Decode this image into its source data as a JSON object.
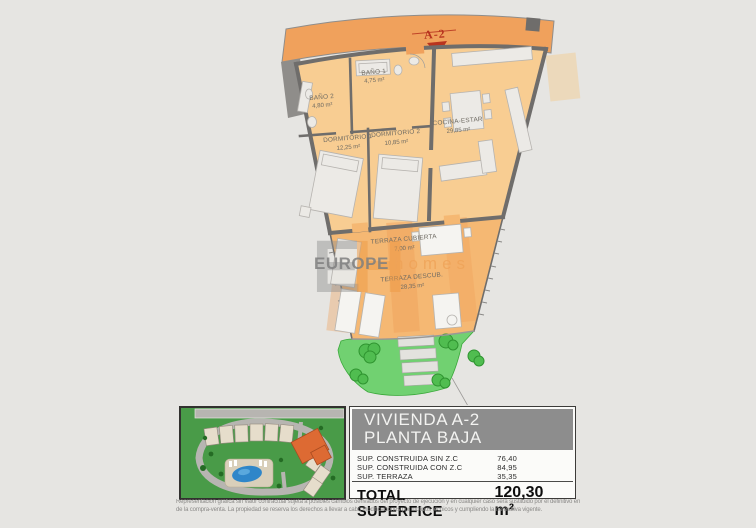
{
  "marker": {
    "label": "A-2"
  },
  "watermark": {
    "monogram_left": "E",
    "monogram_right": "H",
    "brand_primary": "EUROPE",
    "brand_secondary": "homes"
  },
  "rooms": {
    "bano1": {
      "name": "BAÑO 1",
      "area": "4,75 m²"
    },
    "bano2": {
      "name": "BAÑO 2",
      "area": "4,80 m²"
    },
    "dorm1": {
      "name": "DORMITORIO 1",
      "area": "12,25 m²"
    },
    "dorm2": {
      "name": "DORMITORIO 2",
      "area": "10,85 m²"
    },
    "cocina": {
      "name": "COCINA-ESTAR",
      "area": "29,85 m²"
    },
    "terraza_cubierta": {
      "name": "TERRAZA CUBIERTA",
      "area": "7,00 m²"
    },
    "terraza_descubierta": {
      "name": "TERRAZA DESCUB.",
      "area": "28,35 m²"
    }
  },
  "info_panel": {
    "title_line1": "VIVIENDA A-2",
    "title_line2": "PLANTA BAJA",
    "rows": [
      {
        "label": "SUP. CONSTRUIDA SIN Z.C",
        "value": "76,40"
      },
      {
        "label": "SUP. CONSTRUIDA CON Z.C",
        "value": "84,95"
      },
      {
        "label": "SUP. TERRAZA",
        "value": "35,35"
      }
    ],
    "total_label": "TOTAL SUPERFICE",
    "total_value": "120,30 m²"
  },
  "disclaimer": {
    "line1": "Representación gráfica sin valor contractual sujeta a posibles cambios derivados del proyecto de ejecución y en cualquier caso será sustituido por el definitivo en",
    "line2": "de la compra-venta. La propiedad se reserva los derechos a llevar a cabo modificaciones por motivos técnicos y cumpliendo la normativa vigente."
  },
  "colors": {
    "band_orange": "#f0a15c",
    "room_peach": "#f8cd92",
    "terrace_orange": "#f5b873",
    "wall_gray": "#6f6d6b",
    "garden_green": "#71d171",
    "marker_red": "#b8341f",
    "header_gray": "#8d8d8d"
  }
}
